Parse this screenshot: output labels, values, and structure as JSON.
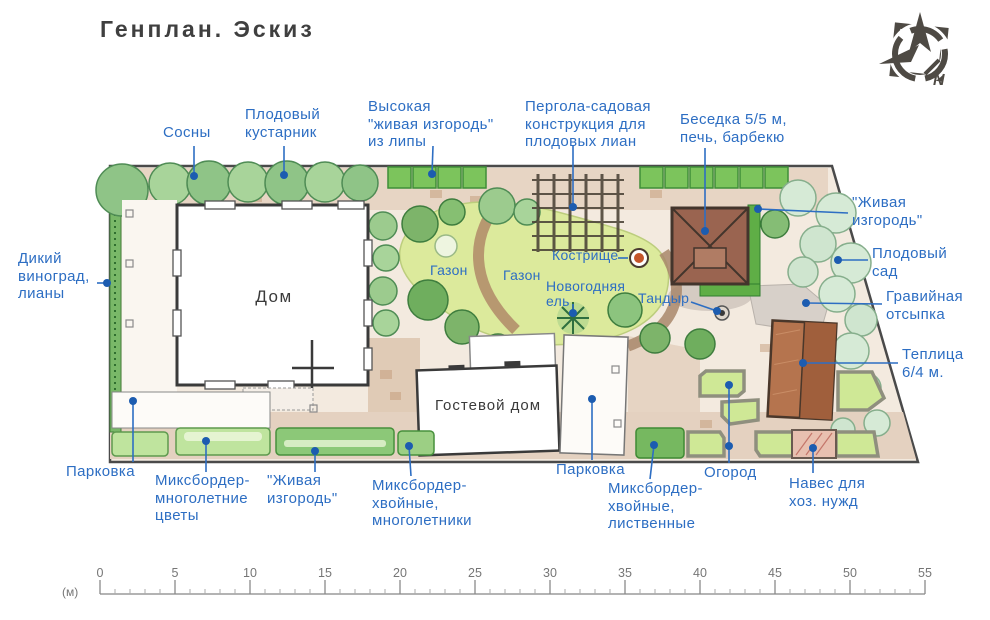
{
  "title": "Генплан. Эскиз",
  "compass": {
    "north_letter": "N"
  },
  "colors": {
    "callout_blue": "#2d6ec3",
    "ink": "#3f3f3f",
    "lawn_green": "#dcea9c",
    "hedge_green": "#7cc45c",
    "gazebo_brown": "#9a6450",
    "greenhouse_brown": "#b5744e"
  },
  "callouts": {
    "pines": "Сосны",
    "fruit_shrub": "Плодовый\nкустарник",
    "linden_hedge": "Высокая\n\"живая изгородь\"\nиз липы",
    "pergola": "Пергола-садовая\nконструкция для\nплодовых лиан",
    "gazebo": "Беседка 5/5 м,\nпечь, барбекю",
    "hedge_right": "\"Живая\nизгородь\"",
    "orchard": "Плодовый\nсад",
    "gravel": "Гравийная\nотсыпка",
    "greenhouse": "Теплица\n6/4 м.",
    "wild_grape": "Дикий\nвиноград,\nлианы",
    "parking_left": "Парковка",
    "mixborder_flowers": "Миксбордер-\nмноголетние\nцветы",
    "hedge_bottom": "\"Живая\nизгородь\"",
    "mixborder_conifer_perennials": "Миксбордер-\nхвойные,\nмноголетники",
    "parking_center": "Парковка",
    "mixborder_conifer_deciduous": "Миксбордер-\nхвойные,\nлиственные",
    "kitchen_garden": "Огород",
    "utility_shed": "Навес для\nхоз. нужд"
  },
  "plan_labels": {
    "house": "Дом",
    "guest_house": "Гостевой дом",
    "lawn_1": "Газон",
    "lawn_2": "Газон",
    "fire_pit": "Кострище",
    "new_year_spruce": "Новогодняя\nель",
    "tandoor": "Тандыр"
  },
  "scale_bar": {
    "unit": "(м)",
    "ticks": [
      0,
      5,
      10,
      15,
      20,
      25,
      30,
      35,
      40,
      45,
      50,
      55
    ]
  }
}
